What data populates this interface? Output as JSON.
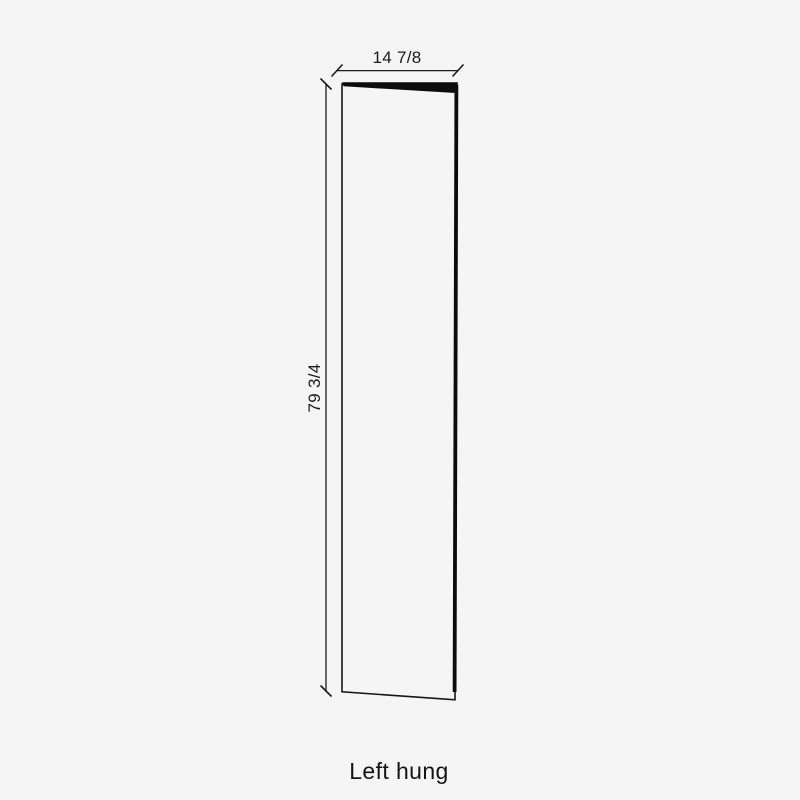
{
  "colors": {
    "background": "#f5f5f5",
    "ink": "#1a1a1a",
    "door_face_fill": "#f5f5f5",
    "door_edge_fill": "#0c0c0c"
  },
  "diagram": {
    "caption": "Left hung",
    "width_dimension_label": "14 7/8",
    "height_dimension_label": "79 3/4"
  }
}
